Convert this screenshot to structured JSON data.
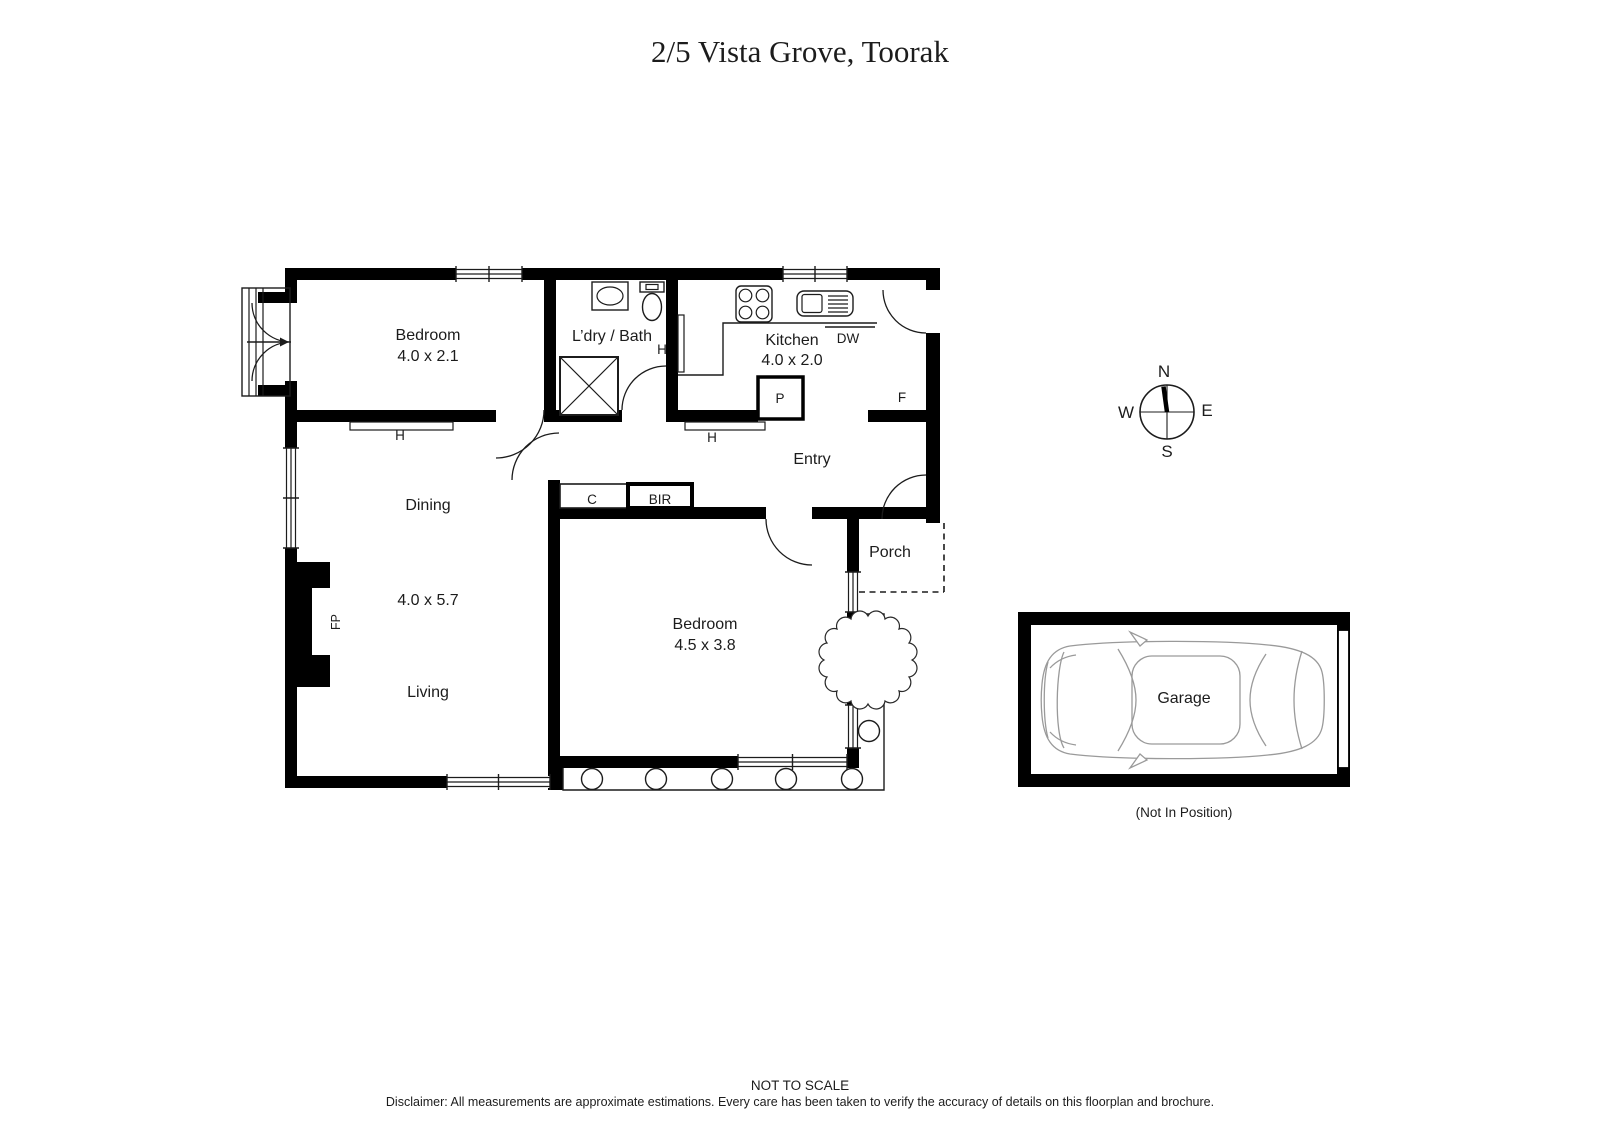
{
  "title": "2/5 Vista Grove, Toorak",
  "rooms": {
    "bedroom1": {
      "name": "Bedroom",
      "dims": "4.0 x 2.1"
    },
    "laundry_bath": {
      "name": "L’dry / Bath"
    },
    "kitchen": {
      "name": "Kitchen",
      "dims": "4.0 x 2.0"
    },
    "dining": {
      "name": "Dining"
    },
    "living": {
      "name": "Living"
    },
    "living_dining_dims": "4.0 x 5.7",
    "bedroom2": {
      "name": "Bedroom",
      "dims": "4.5 x 3.8"
    },
    "entry": {
      "name": "Entry"
    },
    "porch": {
      "name": "Porch"
    },
    "garage": {
      "name": "Garage"
    }
  },
  "labels": {
    "heater": "H",
    "cupboard": "C",
    "built_in_robe": "BIR",
    "pantry": "P",
    "fridge": "F",
    "dishwasher": "DW",
    "fireplace": "FP"
  },
  "compass": {
    "n": "N",
    "s": "S",
    "e": "E",
    "w": "W"
  },
  "garage_note": "(Not In Position)",
  "footer": {
    "scale": "NOT TO SCALE",
    "disclaimer": "Disclaimer: All measurements are approximate estimations. Every care has been taken to verify the accuracy of details on this floorplan and brochure."
  },
  "colors": {
    "wall": "#000000",
    "background": "#ffffff",
    "car_outline": "#9a9a9a"
  }
}
